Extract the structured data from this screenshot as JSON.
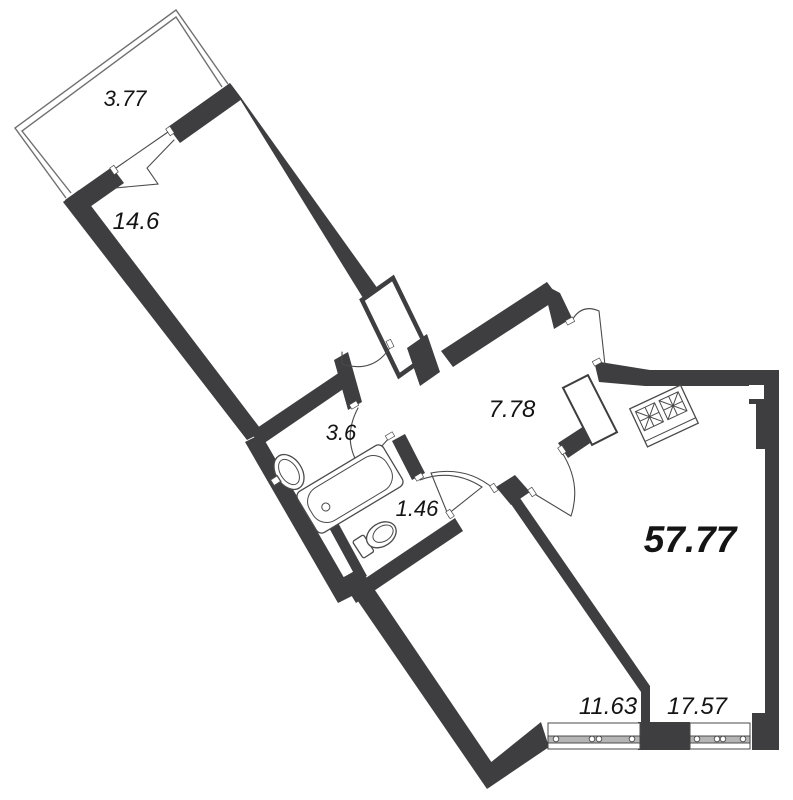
{
  "plan": {
    "type": "apartment-floor-plan",
    "total_area": "57.77",
    "rooms": {
      "balcony": "3.77",
      "living_room": "14.6",
      "bathroom": "3.6",
      "hallway": "7.78",
      "wc": "1.46",
      "bedroom": "11.63",
      "kitchen_living": "17.57"
    },
    "fixtures": [
      "bathtub",
      "sink",
      "toilet",
      "stove",
      "ventilation-shaft",
      "windows",
      "doors"
    ],
    "colors": {
      "wall": "#3e3e40",
      "line": "#4a4a4a",
      "balcony_line": "#707070",
      "window_band": "#b5b5b5",
      "text": "#141414",
      "background": "#ffffff"
    }
  }
}
